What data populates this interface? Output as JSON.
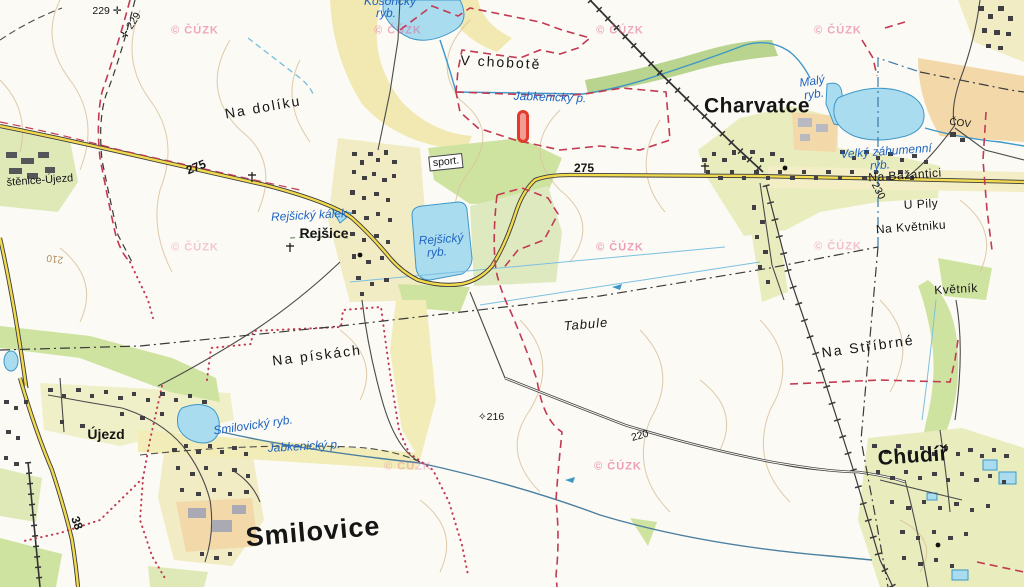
{
  "map": {
    "attribution": "© ČÚZK",
    "marker": {
      "x": 517,
      "y": 110,
      "w": 12,
      "h": 33,
      "color": "#e23b2e",
      "fill": "rgba(235,80,70,0.55)"
    },
    "colors": {
      "water": "#aadcef",
      "water_line": "#3f97c8",
      "road_fill": "#f2da4e",
      "road_casing": "#3c3c3c",
      "boundary_red": "#c23a52",
      "contour": "#dcc5a2",
      "forest_green": "#cde0a0",
      "village_yellow": "#f1ecc4",
      "orchard_tan": "#f3d9a9",
      "marker_red": "#e23b2e",
      "water_label_blue": "#1f64c2"
    },
    "labels": [
      {
        "id": "spot-229-a",
        "text": "229 ✛",
        "x": 107,
        "y": 11,
        "rot": 0,
        "cls": "elev"
      },
      {
        "id": "spot-229-b",
        "text": "✛ 229",
        "x": 131,
        "y": 26,
        "rot": -58,
        "cls": "elev"
      },
      {
        "id": "na-doliku",
        "text": "Na dolíku",
        "x": 263,
        "y": 107,
        "rot": -10,
        "cls": "field-lg"
      },
      {
        "id": "v-chobote",
        "text": "V chobotě",
        "x": 501,
        "y": 62,
        "rot": 3,
        "cls": "field-lg"
      },
      {
        "id": "jabkenicky-p-top",
        "text": "Jabkenický p.",
        "x": 550,
        "y": 97,
        "rot": 2,
        "cls": "water"
      },
      {
        "id": "charvatce",
        "text": "Charvatce",
        "x": 757,
        "y": 106,
        "rot": 0,
        "cls": "town-lg"
      },
      {
        "id": "maly-ryb-1",
        "text": "Malý",
        "x": 812,
        "y": 81,
        "rot": -8,
        "cls": "water"
      },
      {
        "id": "maly-ryb-2",
        "text": "ryb.",
        "x": 814,
        "y": 94,
        "rot": -8,
        "cls": "water"
      },
      {
        "id": "velky-zahumenni-1",
        "text": "Velký záhumenní",
        "x": 886,
        "y": 151,
        "rot": -4,
        "cls": "water"
      },
      {
        "id": "velky-zahumenni-2",
        "text": "ryb.",
        "x": 880,
        "y": 165,
        "rot": -4,
        "cls": "water"
      },
      {
        "id": "na-bazantici",
        "text": "Na Bažantici",
        "x": 905,
        "y": 175,
        "rot": -4,
        "cls": "field"
      },
      {
        "id": "u-pily",
        "text": "U Pily",
        "x": 921,
        "y": 204,
        "rot": -3,
        "cls": "field"
      },
      {
        "id": "na-kvetniku",
        "text": "Na Květniku",
        "x": 911,
        "y": 227,
        "rot": -4,
        "cls": "field"
      },
      {
        "id": "kvetnik",
        "text": "Květník",
        "x": 956,
        "y": 289,
        "rot": -3,
        "cls": "field"
      },
      {
        "id": "spot-230",
        "text": "230",
        "x": 878,
        "y": 191,
        "rot": 62,
        "cls": "elev"
      },
      {
        "id": "cov",
        "text": "ČOV",
        "x": 960,
        "y": 124,
        "rot": 8,
        "cls": "poi"
      },
      {
        "id": "sport",
        "text": "sport.",
        "x": 446,
        "y": 162,
        "rot": -6,
        "cls": "boxed"
      },
      {
        "id": "rejsicky-kalek",
        "text": "Rejšický kálek",
        "x": 309,
        "y": 215,
        "rot": -3,
        "cls": "water"
      },
      {
        "id": "rejsice",
        "text": "Rejšice",
        "x": 324,
        "y": 233,
        "rot": 0,
        "cls": "town"
      },
      {
        "id": "rejsicky-ryb-1",
        "text": "Rejšický",
        "x": 441,
        "y": 239,
        "rot": -4,
        "cls": "water"
      },
      {
        "id": "rejsicky-ryb-2",
        "text": "ryb.",
        "x": 437,
        "y": 252,
        "rot": -4,
        "cls": "water"
      },
      {
        "id": "road-275-w",
        "text": "275",
        "x": 196,
        "y": 167,
        "rot": -22,
        "cls": "road"
      },
      {
        "id": "road-275-e",
        "text": "275",
        "x": 584,
        "y": 168,
        "rot": 0,
        "cls": "road"
      },
      {
        "id": "tabule",
        "text": "Tabule",
        "x": 586,
        "y": 324,
        "rot": -5,
        "cls": "field-it"
      },
      {
        "id": "na-stribrne",
        "text": "Na Stříbrné",
        "x": 868,
        "y": 346,
        "rot": -8,
        "cls": "field-lg"
      },
      {
        "id": "na-piskach",
        "text": "Na pískách",
        "x": 317,
        "y": 355,
        "rot": -7,
        "cls": "field-lg"
      },
      {
        "id": "smilovicky-ryb",
        "text": "Smilovický ryb.",
        "x": 253,
        "y": 425,
        "rot": -8,
        "cls": "water"
      },
      {
        "id": "jabkenicky-p-bottom",
        "text": "Jabkenický p.",
        "x": 304,
        "y": 446,
        "rot": -3,
        "cls": "water"
      },
      {
        "id": "ujezd",
        "text": "Újezd",
        "x": 106,
        "y": 434,
        "rot": 0,
        "cls": "town"
      },
      {
        "id": "smilovice",
        "text": "Smilovice",
        "x": 313,
        "y": 532,
        "rot": -5,
        "cls": "town-xl"
      },
      {
        "id": "chudir",
        "text": "Chudíř",
        "x": 913,
        "y": 456,
        "rot": -4,
        "cls": "town-lg"
      },
      {
        "id": "spot-216",
        "text": "✧216",
        "x": 491,
        "y": 417,
        "rot": 0,
        "cls": "elev"
      },
      {
        "id": "spot-220",
        "text": "220",
        "x": 640,
        "y": 436,
        "rot": -16,
        "cls": "elev"
      },
      {
        "id": "contour-210",
        "text": "210",
        "x": 55,
        "y": 258,
        "rot": 188,
        "cls": "contour"
      },
      {
        "id": "road-38",
        "text": "38",
        "x": 77,
        "y": 523,
        "rot": 70,
        "cls": "road"
      },
      {
        "id": "lustenice-ujezd",
        "text": "štěnice-Újezd",
        "x": 40,
        "y": 181,
        "rot": -4,
        "cls": "field-sm"
      },
      {
        "id": "kosoricky-ryb-1",
        "text": "Kosořický",
        "x": 390,
        "y": 1,
        "rot": 0,
        "cls": "water"
      },
      {
        "id": "kosoricky-ryb-2",
        "text": "ryb.",
        "x": 386,
        "y": 13,
        "rot": 0,
        "cls": "water"
      }
    ],
    "watermarks": [
      {
        "x": 195,
        "y": 31,
        "o": 0.5
      },
      {
        "x": 398,
        "y": 31,
        "o": 0.45
      },
      {
        "x": 620,
        "y": 31,
        "o": 0.5
      },
      {
        "x": 838,
        "y": 31,
        "o": 0.5
      },
      {
        "x": 195,
        "y": 248,
        "o": 0.3
      },
      {
        "x": 620,
        "y": 248,
        "o": 0.55
      },
      {
        "x": 838,
        "y": 247,
        "o": 0.35
      },
      {
        "x": 408,
        "y": 467,
        "o": 0.3
      },
      {
        "x": 618,
        "y": 467,
        "o": 0.55
      }
    ]
  }
}
